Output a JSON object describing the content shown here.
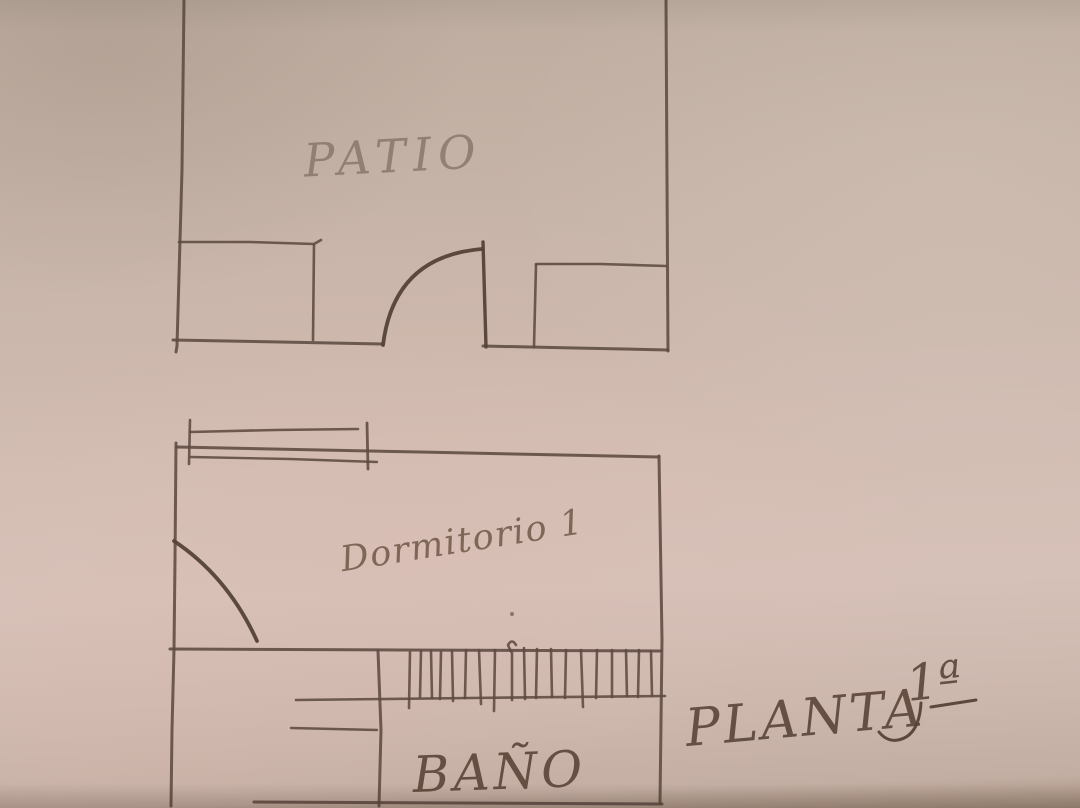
{
  "photo": {
    "kind": "hand-drawn floor plan sketch on beige paper",
    "floor_title": {
      "word": "PLANTA",
      "ordinal": "1ª",
      "full": "PLANTA 1ª"
    },
    "rooms": [
      {
        "id": "patio",
        "label": "PATIO"
      },
      {
        "id": "dormitorio-1",
        "label": "Dormitorio 1"
      },
      {
        "id": "bano",
        "label": "BAÑO"
      }
    ],
    "features": [
      {
        "id": "patio-door",
        "type": "door-swing"
      },
      {
        "id": "dormitorio-door",
        "type": "door-swing"
      },
      {
        "id": "dormitorio-window",
        "type": "window"
      },
      {
        "id": "hatched-wall",
        "type": "hatched-wall-section"
      }
    ],
    "colors": {
      "paper": "#c8b5a9",
      "paper_pink": "#d6c0b7",
      "ink": "#5d4a41",
      "ink_faded": "#8e7b70"
    }
  }
}
